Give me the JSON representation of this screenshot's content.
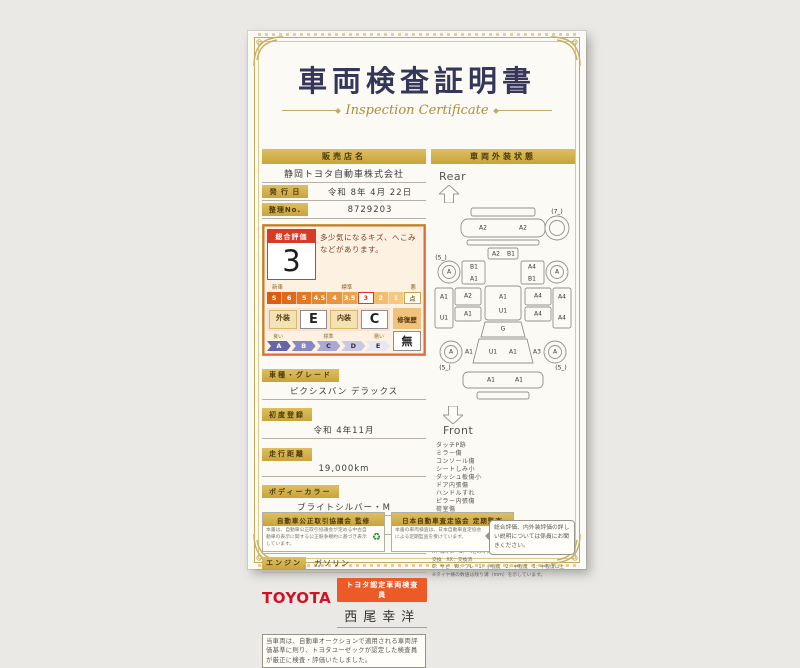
{
  "header": {
    "title": "車両検査証明書",
    "subtitle": "Inspection Certificate"
  },
  "seller": {
    "label": "販売店名",
    "value": "静岡トヨタ自動車株式会社"
  },
  "issue": {
    "label": "発 行 日",
    "value": "令和 8年 4月 22日"
  },
  "ref_no": {
    "label": "整理No.",
    "value": "8729203"
  },
  "rating": {
    "overall_label": "総合評価",
    "overall_value": "3",
    "comment": "多少気になるキズ、へこみなどがあります。",
    "scale_left": "新車",
    "scale_mid": "標準",
    "scale_right": "悪",
    "scale": [
      {
        "v": "S"
      },
      {
        "v": "6"
      },
      {
        "v": "5"
      },
      {
        "v": "4.5"
      },
      {
        "v": "4"
      },
      {
        "v": "3.5"
      },
      {
        "v": "3",
        "hl": true
      },
      {
        "v": "2"
      },
      {
        "v": "1"
      }
    ],
    "scale_unit": "点",
    "exterior_label": "外装",
    "exterior_value": "E",
    "interior_label": "内装",
    "interior_value": "C",
    "repair_label": "修復歴",
    "repair_value": "無",
    "grade_left": "良い",
    "grade_mid": "標準",
    "grade_right": "悪い",
    "grades": [
      "A",
      "B",
      "C",
      "D",
      "E"
    ]
  },
  "fields": [
    {
      "label": "車種・グレード",
      "value": "ピクシスバン デラックス"
    },
    {
      "label": "初度登録",
      "value": "令和 4年11月"
    },
    {
      "label": "走行距離",
      "value": "19,000km"
    },
    {
      "label": "ボディーカラー",
      "value": "ブライトシルバー・M"
    }
  ],
  "fields_inline": [
    {
      "label": "型  式",
      "value": "3BD-S710M"
    },
    {
      "label": "車台番号",
      "value": "XXXXXXXX695"
    },
    {
      "label": "エンジン",
      "value": "ガソリン"
    }
  ],
  "inspector": {
    "brand": "TOYOTA",
    "badge": "トヨタ認定車両検査員",
    "name": "西尾幸洋"
  },
  "disclaimer": "当車両は、自動車オークションで適用される車両評価基準に則り、トヨタユーゼックが認定した検査員が厳正に検査・評価いたしました。",
  "footer": {
    "left_title": "自動車公正取引協議会 監修",
    "left_body": "本書は、自動車公正取引協議会が定める中古自動車の表示に関する公正競争規約に基づき表示しています。",
    "left_logo": "green-seal-icon",
    "right_title": "日本自動車査定協会 定期監査",
    "right_body": "本書の車両検査は、日本自動車査定協会による定期監査を受けています。",
    "right_logo": "JAAI"
  },
  "exterior": {
    "header": "車両外装状態",
    "rear_label": "Rear",
    "front_label": "Front",
    "labels": [
      {
        "t": "A2",
        "x": 52,
        "y": 22
      },
      {
        "t": "A2",
        "x": 92,
        "y": 22
      },
      {
        "t": "(7_)",
        "x": 126,
        "y": 6
      },
      {
        "t": "A2",
        "x": 65,
        "y": 48
      },
      {
        "t": "B1",
        "x": 80,
        "y": 48
      },
      {
        "t": "(5_)",
        "x": 10,
        "y": 52
      },
      {
        "t": "A",
        "x": 18,
        "y": 66
      },
      {
        "t": "A",
        "x": 126,
        "y": 66
      },
      {
        "t": "B1",
        "x": 43,
        "y": 61
      },
      {
        "t": "A1",
        "x": 43,
        "y": 73
      },
      {
        "t": "A4",
        "x": 101,
        "y": 61
      },
      {
        "t": "B1",
        "x": 101,
        "y": 73
      },
      {
        "t": "A1",
        "x": 13,
        "y": 91
      },
      {
        "t": "U1",
        "x": 13,
        "y": 112
      },
      {
        "t": "A2",
        "x": 37,
        "y": 90
      },
      {
        "t": "A1",
        "x": 37,
        "y": 108
      },
      {
        "t": "A4",
        "x": 107,
        "y": 90
      },
      {
        "t": "A4",
        "x": 107,
        "y": 108
      },
      {
        "t": "A4",
        "x": 131,
        "y": 91
      },
      {
        "t": "A4",
        "x": 131,
        "y": 112
      },
      {
        "t": "A1",
        "x": 72,
        "y": 91
      },
      {
        "t": "U1",
        "x": 72,
        "y": 105
      },
      {
        "t": "G",
        "x": 72,
        "y": 123
      },
      {
        "t": "U1",
        "x": 62,
        "y": 146
      },
      {
        "t": "A1",
        "x": 82,
        "y": 146
      },
      {
        "t": "A",
        "x": 20,
        "y": 146
      },
      {
        "t": "A1",
        "x": 38,
        "y": 146
      },
      {
        "t": "A3",
        "x": 106,
        "y": 146
      },
      {
        "t": "A",
        "x": 124,
        "y": 146
      },
      {
        "t": "(5_)",
        "x": 14,
        "y": 162
      },
      {
        "t": "(5_)",
        "x": 130,
        "y": 162
      },
      {
        "t": "A1",
        "x": 60,
        "y": 174
      },
      {
        "t": "A1",
        "x": 88,
        "y": 174
      }
    ],
    "notes": [
      "タッチP跡",
      "ミラー傷",
      "コンソール傷",
      "シートしみ小",
      "ダッシュ板傷小",
      "ドア内張傷",
      "ハンドルすれ",
      "ピラー内張傷",
      "荷室傷",
      "ドアきしみ有り"
    ],
    "legend_title": "車両外装状態の表示記号について",
    "legend_example": "（例(A1)＝線キズ小程度のもの）",
    "legend_lines": [
      "A：線キズ　B：へこみキズ　U：へこみ　G：ガラスキズ　X：要交換　XX：交換済",
      "C：サビ　W：ワレ　1：小程度　2：中程度　3：中程度以上",
      "※タイヤ横の数値は残り溝（mm）を示しています。"
    ],
    "bubble": "総合評価、内外装評価の詳しい説明については係員にお聞きください。"
  }
}
